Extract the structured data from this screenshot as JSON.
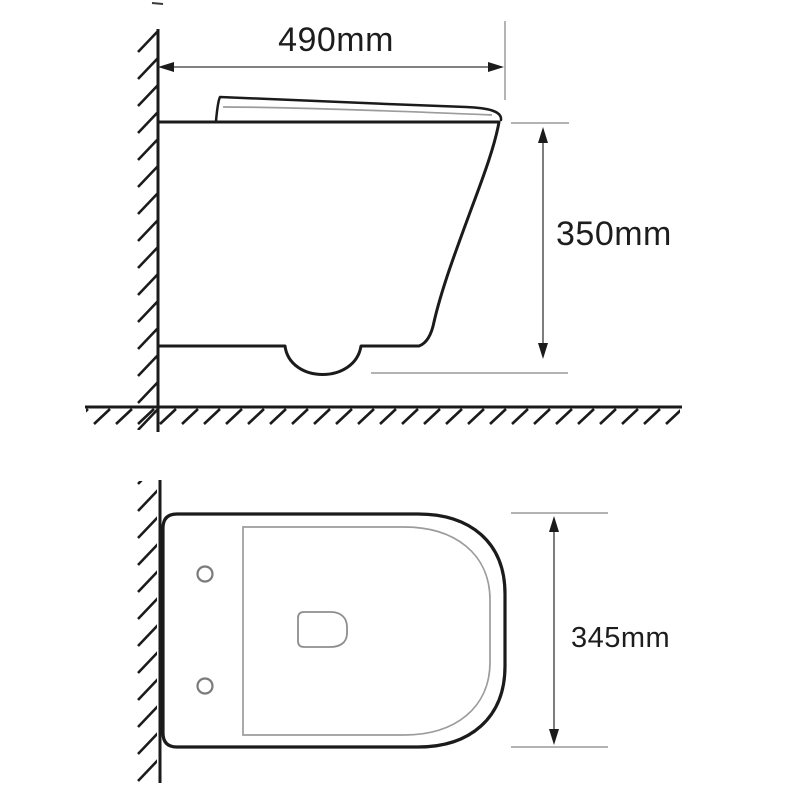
{
  "diagram": {
    "subject": "wall-hung-toilet-technical-drawing",
    "views": {
      "side_view_name": "side elevation with wall and floor section",
      "top_view_name": "plan view with wall section"
    },
    "side_view": {
      "width_dim": {
        "label": "490mm",
        "orientation": "horizontal"
      },
      "height_dim": {
        "label": "350mm",
        "orientation": "vertical"
      }
    },
    "top_view": {
      "depth_dim": {
        "label": "345mm",
        "orientation": "vertical"
      }
    },
    "colors": {
      "background": "#ffffff",
      "outline": "#1b1b1b",
      "dim_line": "#6f6f6f",
      "ext_line": "#9a9a9a",
      "inner_line": "#9c9c9c",
      "hole_line": "#7a7a7a",
      "text": "#1d1d1d"
    }
  }
}
